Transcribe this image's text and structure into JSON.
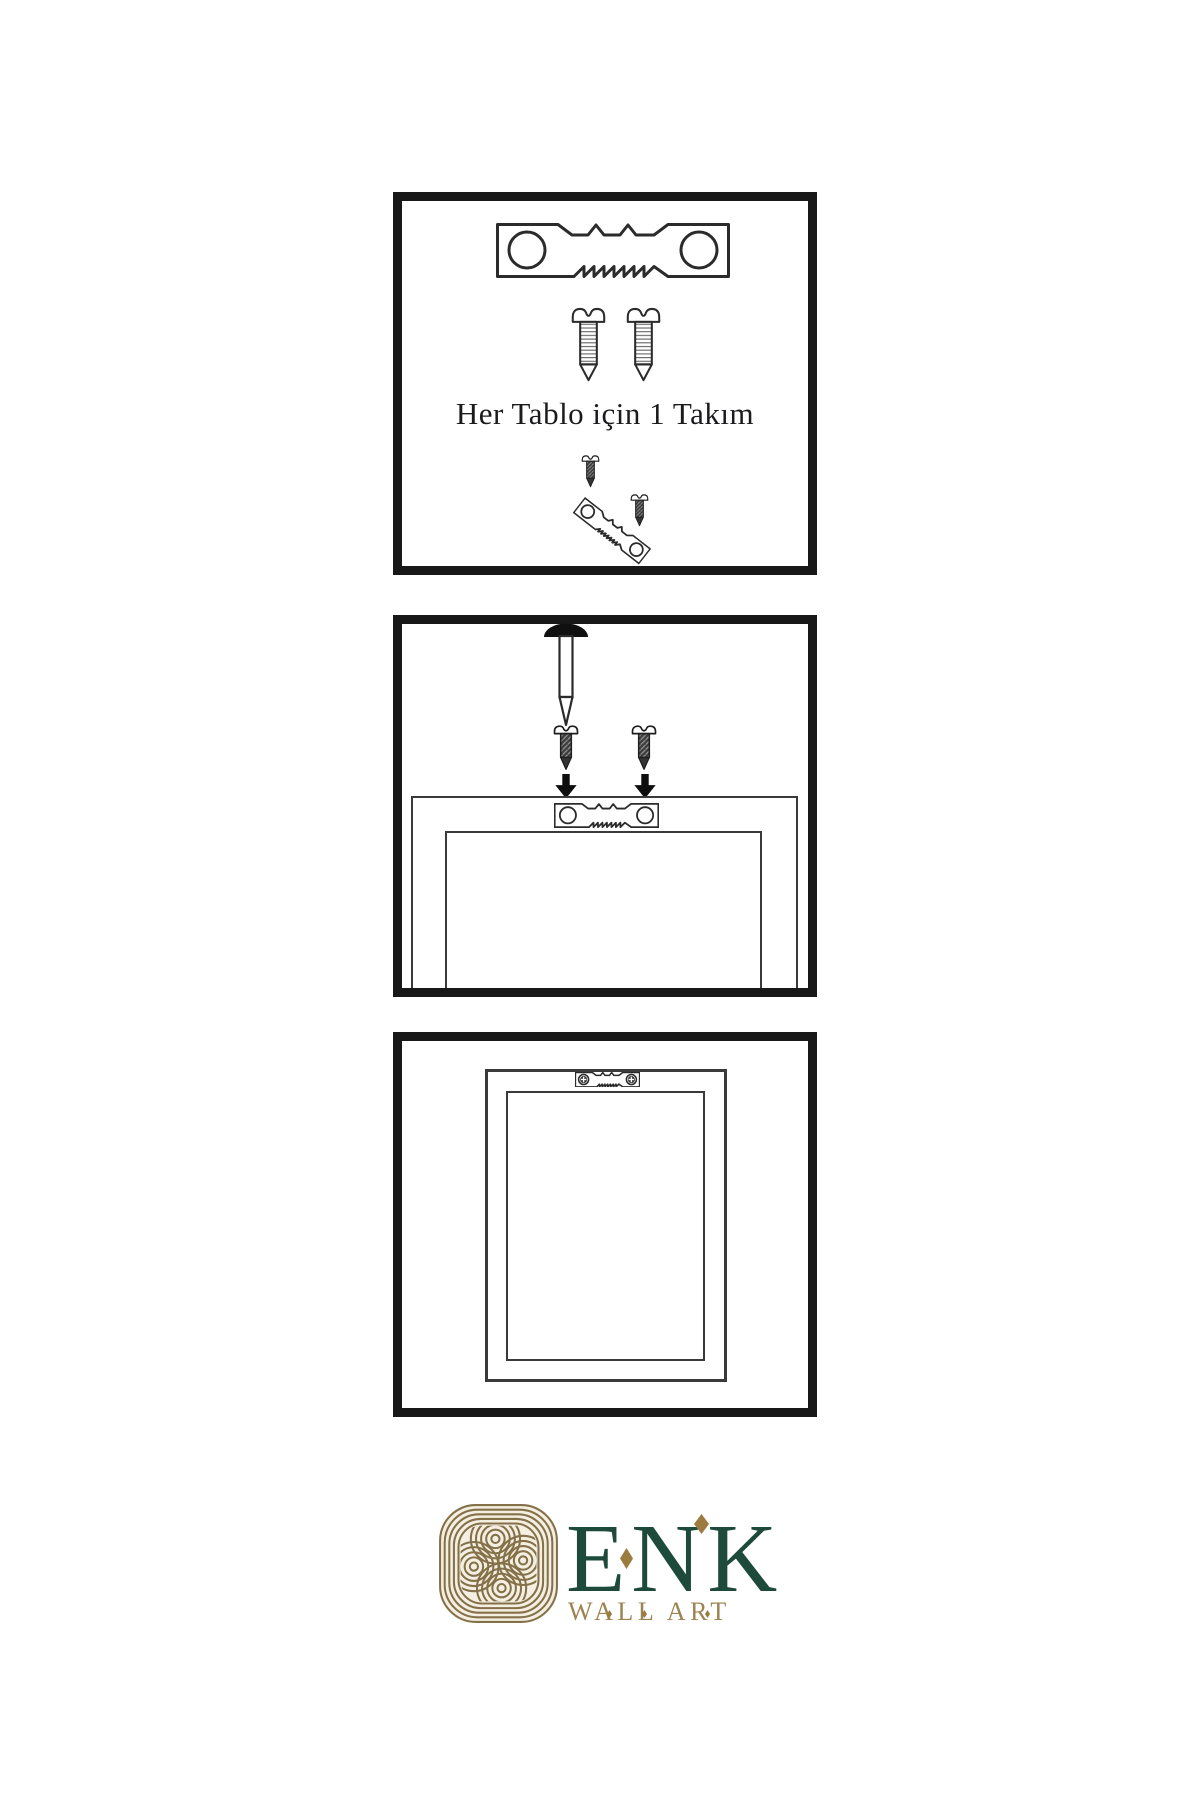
{
  "canvas": {
    "width": 1200,
    "height": 1800,
    "background": "#ffffff"
  },
  "colors": {
    "panel_border": "#181818",
    "line_art": "#2b2b2b",
    "screw_dark_fill": "#3c3c3c",
    "caption_text": "#1b1b1d",
    "brand_green": "#1d4a3a",
    "brand_gold": "#9c8352",
    "diamond_gold": "#9c7c3e",
    "knot_gold": "#84714a",
    "knot_background": "#f5efe1"
  },
  "panels": [
    {
      "step": 1,
      "name": "hardware-kit",
      "caption": "Her Tablo için 1 Takım",
      "contents": [
        "sawtooth-hanger",
        "screw",
        "screw",
        "dark-screw",
        "tilted-sawtooth-hanger",
        "dark-screw"
      ]
    },
    {
      "step": 2,
      "name": "attach-hanger-to-frame-back",
      "contents": [
        "nail",
        "dark-screw",
        "down-arrow",
        "dark-screw",
        "down-arrow",
        "frame-back",
        "sawtooth-hanger"
      ]
    },
    {
      "step": 3,
      "name": "hanger-installed-on-frame",
      "contents": [
        "frame-back",
        "sawtooth-hanger-with-phillips-screws"
      ]
    }
  ],
  "brand": {
    "name": "ENK",
    "subtitle": "WALL ART"
  }
}
